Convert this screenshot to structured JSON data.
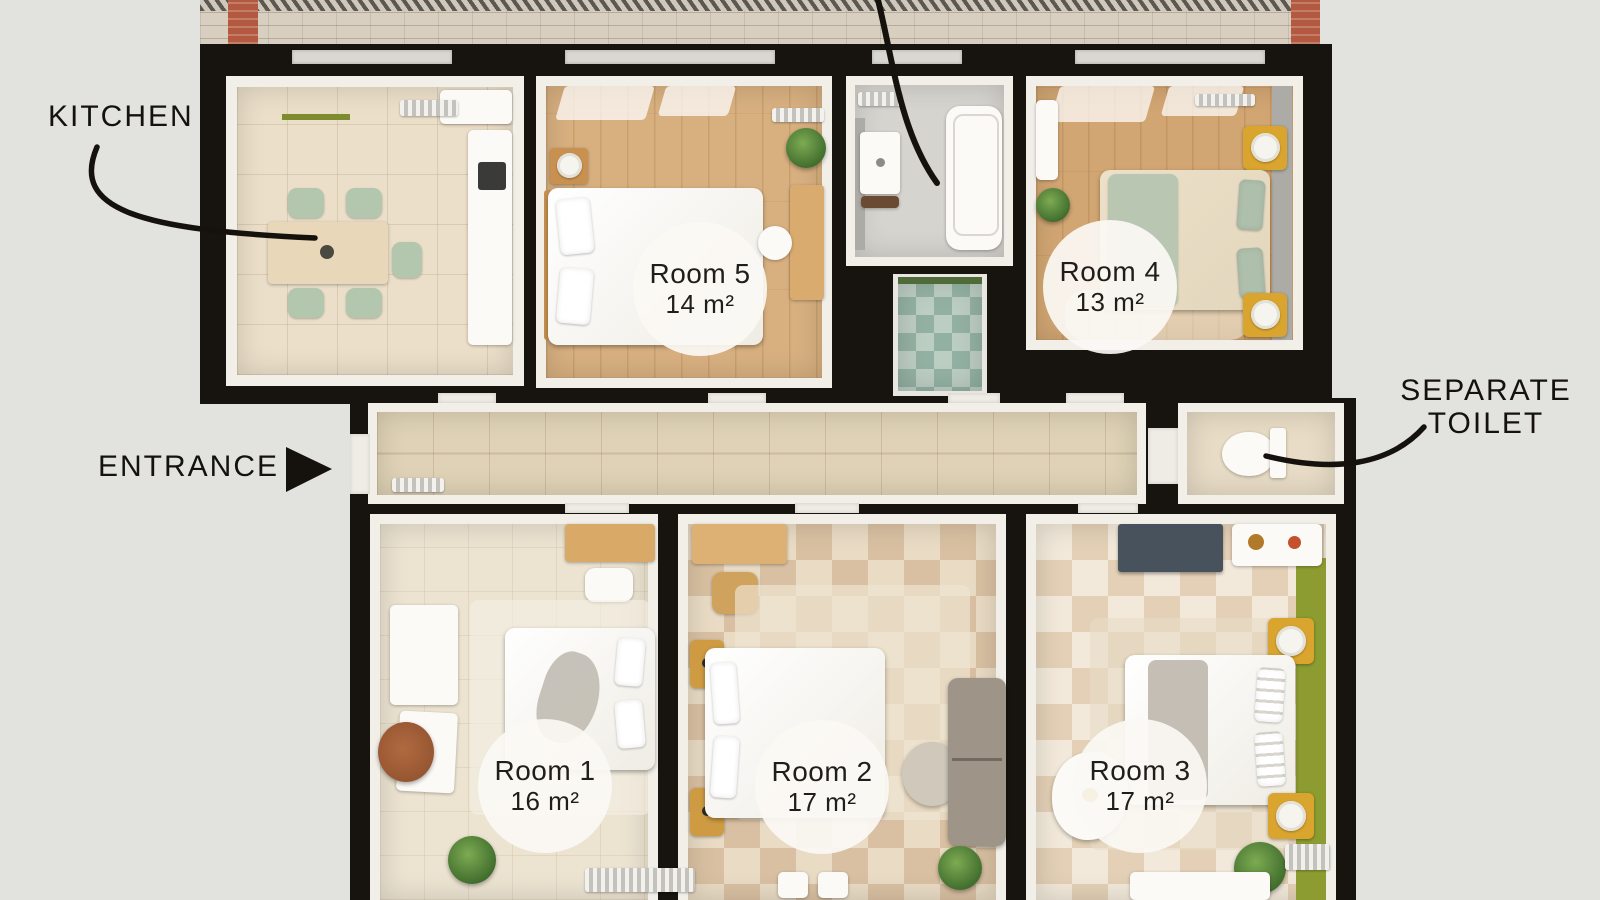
{
  "plan": {
    "labels": {
      "kitchen": "KITCHEN",
      "entrance": "ENTRANCE",
      "separate_toilet": "SEPARATE TOILET"
    },
    "rooms": [
      {
        "name": "Room 1",
        "area": "16 m²"
      },
      {
        "name": "Room 2",
        "area": "17 m²"
      },
      {
        "name": "Room 3",
        "area": "17 m²"
      },
      {
        "name": "Room 4",
        "area": "13 m²"
      },
      {
        "name": "Room 5",
        "area": "14 m²"
      }
    ],
    "colors": {
      "background": "#e2e2de",
      "wall": "#17130e",
      "accent_green_wall": "#8d9c31",
      "brick_red": "#b2593f",
      "wood_floor": "#d8b080",
      "badge_background": "#faf8f3"
    }
  }
}
